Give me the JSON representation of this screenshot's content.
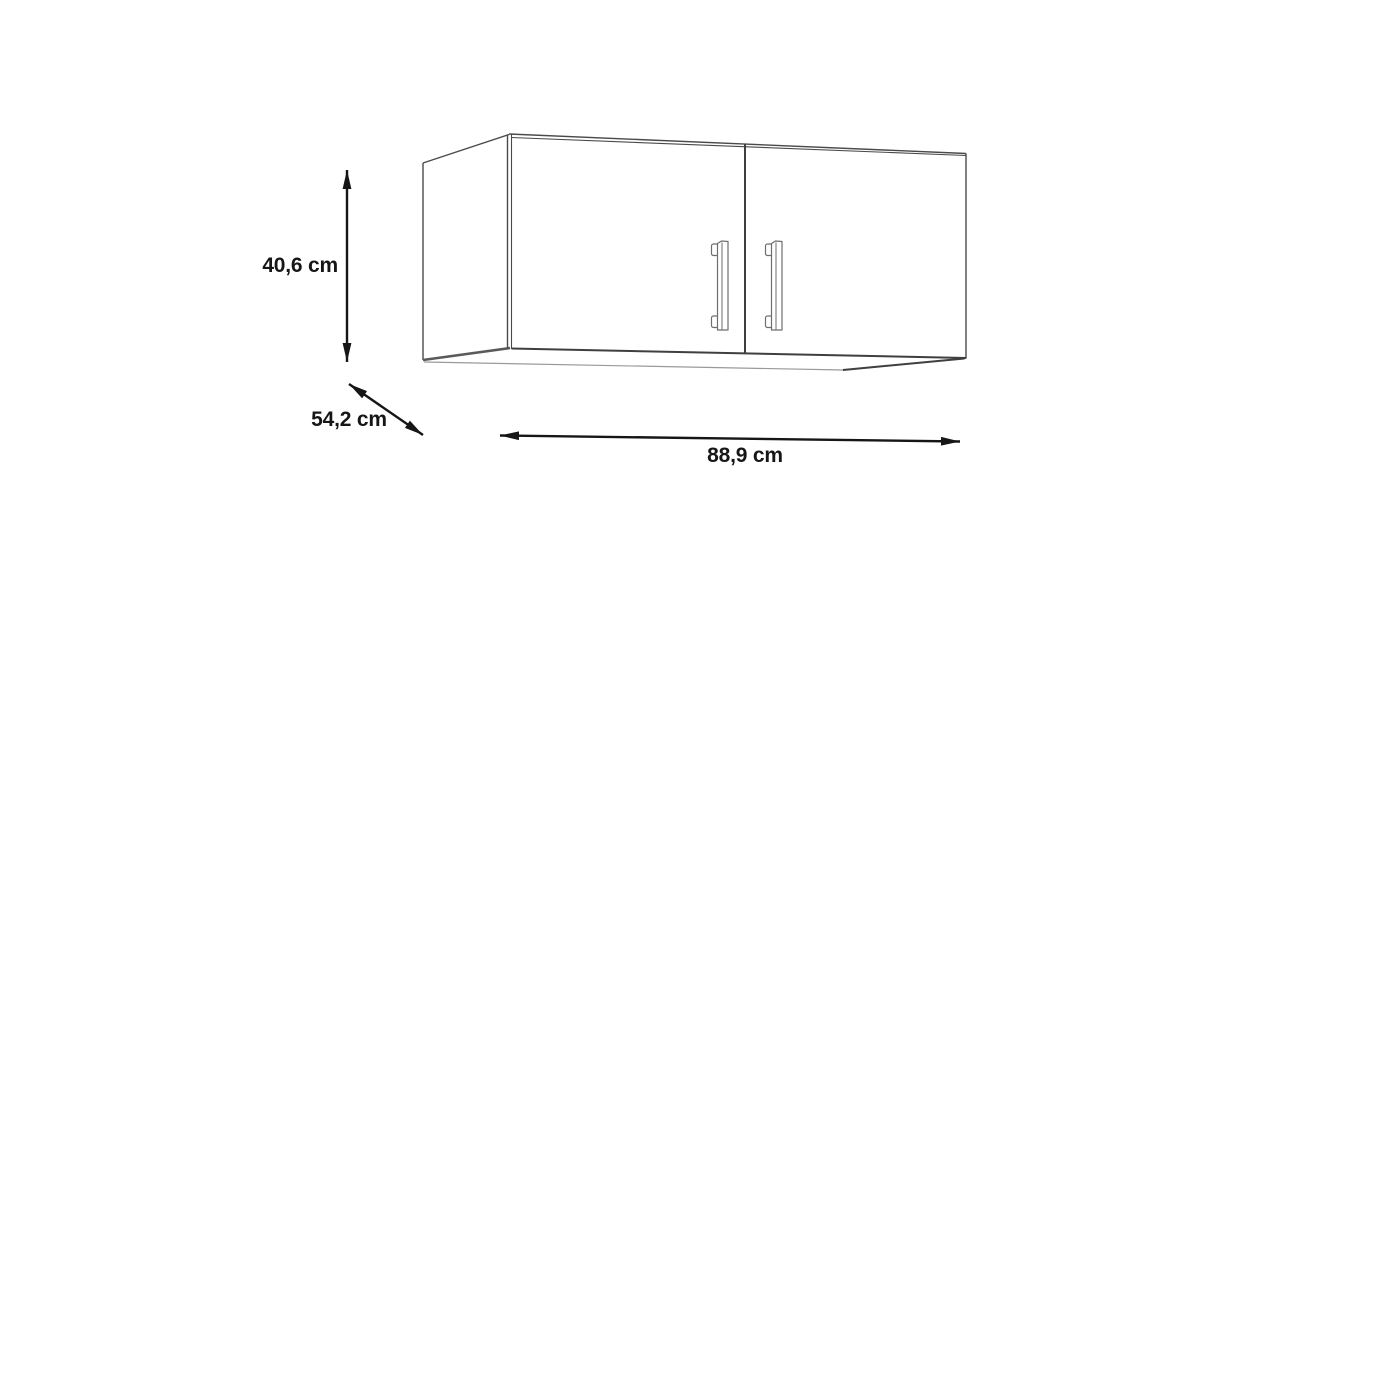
{
  "diagram": {
    "dimensions": {
      "height": {
        "label": "40,6 cm"
      },
      "depth": {
        "label": "54,2 cm"
      },
      "width": {
        "label": "88,9 cm"
      }
    },
    "colors": {
      "background": "#ffffff",
      "outline": "#4a4a4a",
      "outline_light": "#9a9a9a",
      "arrow": "#161616",
      "text": "#161616"
    }
  }
}
